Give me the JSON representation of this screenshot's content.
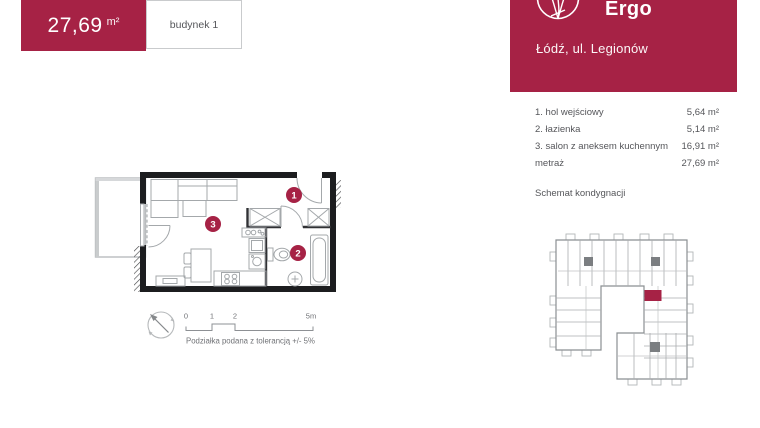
{
  "colors": {
    "accent": "#A62245",
    "wall": "#1c1d1f",
    "line": "#a4a8ab",
    "linedark": "#8b8f92",
    "text": "#55565a",
    "muted": "#707276",
    "border": "#c9cbcd"
  },
  "header": {
    "area_value": "27,69",
    "area_unit": "m²",
    "building_label": "budynek 1"
  },
  "brand": {
    "name": "Ergo",
    "address": "Łódź, ul. Legionów",
    "logo_icon": "lotus-circle-icon"
  },
  "rooms": {
    "items": [
      {
        "label": "1. hol wejściowy",
        "area": "5,64 m²"
      },
      {
        "label": "2. łazienka",
        "area": "5,14 m²"
      },
      {
        "label": "3. salon z aneksem kuchennym",
        "area": "16,91 m²"
      }
    ],
    "total_label": "metraż",
    "total_area": "27,69 m²"
  },
  "floor_section_label": "Schemat kondygnacji",
  "plan": {
    "badges": [
      {
        "label": "1"
      },
      {
        "label": "2"
      },
      {
        "label": "3"
      }
    ],
    "scale": {
      "labels": [
        "0",
        "1",
        "2",
        "5m"
      ],
      "caption": "Podziałka podana z tolerancją +/- 5%"
    },
    "compass_icon": "north-arrow-icon"
  }
}
